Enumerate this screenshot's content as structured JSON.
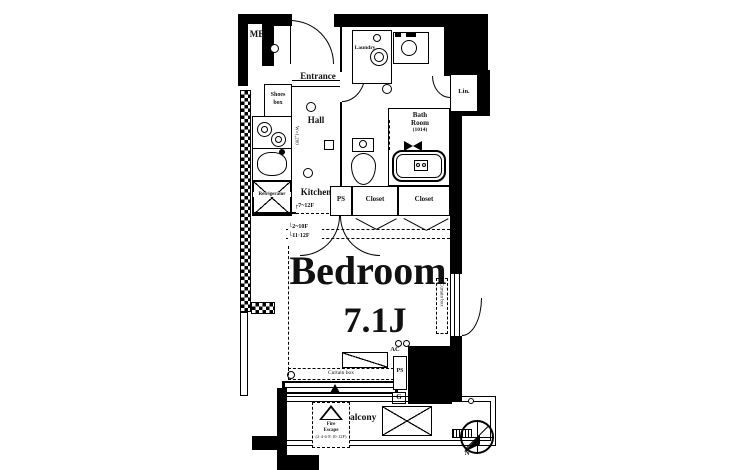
{
  "plan": {
    "labels": {
      "mb": "MB",
      "entrance": "Entrance",
      "shoes_box_1": "Shoes",
      "shoes_box_2": "box",
      "laundry": "Laundry",
      "powder_1": "Powder",
      "powder_2": "Room",
      "lin": "Lin.",
      "hall": "Hall",
      "kitchen": "Kitchen",
      "kitchen_width": "W=1,200",
      "refrigerator": "Refrigerator",
      "bath_1": "Bath",
      "bath_2": "Room",
      "bath_3": "(1014)",
      "ps_upper": "PS",
      "closet_left": "Closet",
      "closet_right": "Closet",
      "floors_upper": "┌7~12F",
      "floors_mid": "└2~10F",
      "floors_lower": "└11·12F",
      "bedroom": "Bedroom",
      "bedroom_size": "7.1J",
      "curtain_box_right": "Curtain box",
      "ac": "AC",
      "curtain_box_bottom": "Curtain box",
      "ps_lower": "PS",
      "gas": "G",
      "balcony": "Balcony",
      "hatch_1": "Fire",
      "hatch_2": "Escape",
      "hatch_3": "(2·4·6·8·10·12F)",
      "north": "N"
    },
    "colors": {
      "wall": "#000000",
      "background": "#ffffff"
    }
  }
}
